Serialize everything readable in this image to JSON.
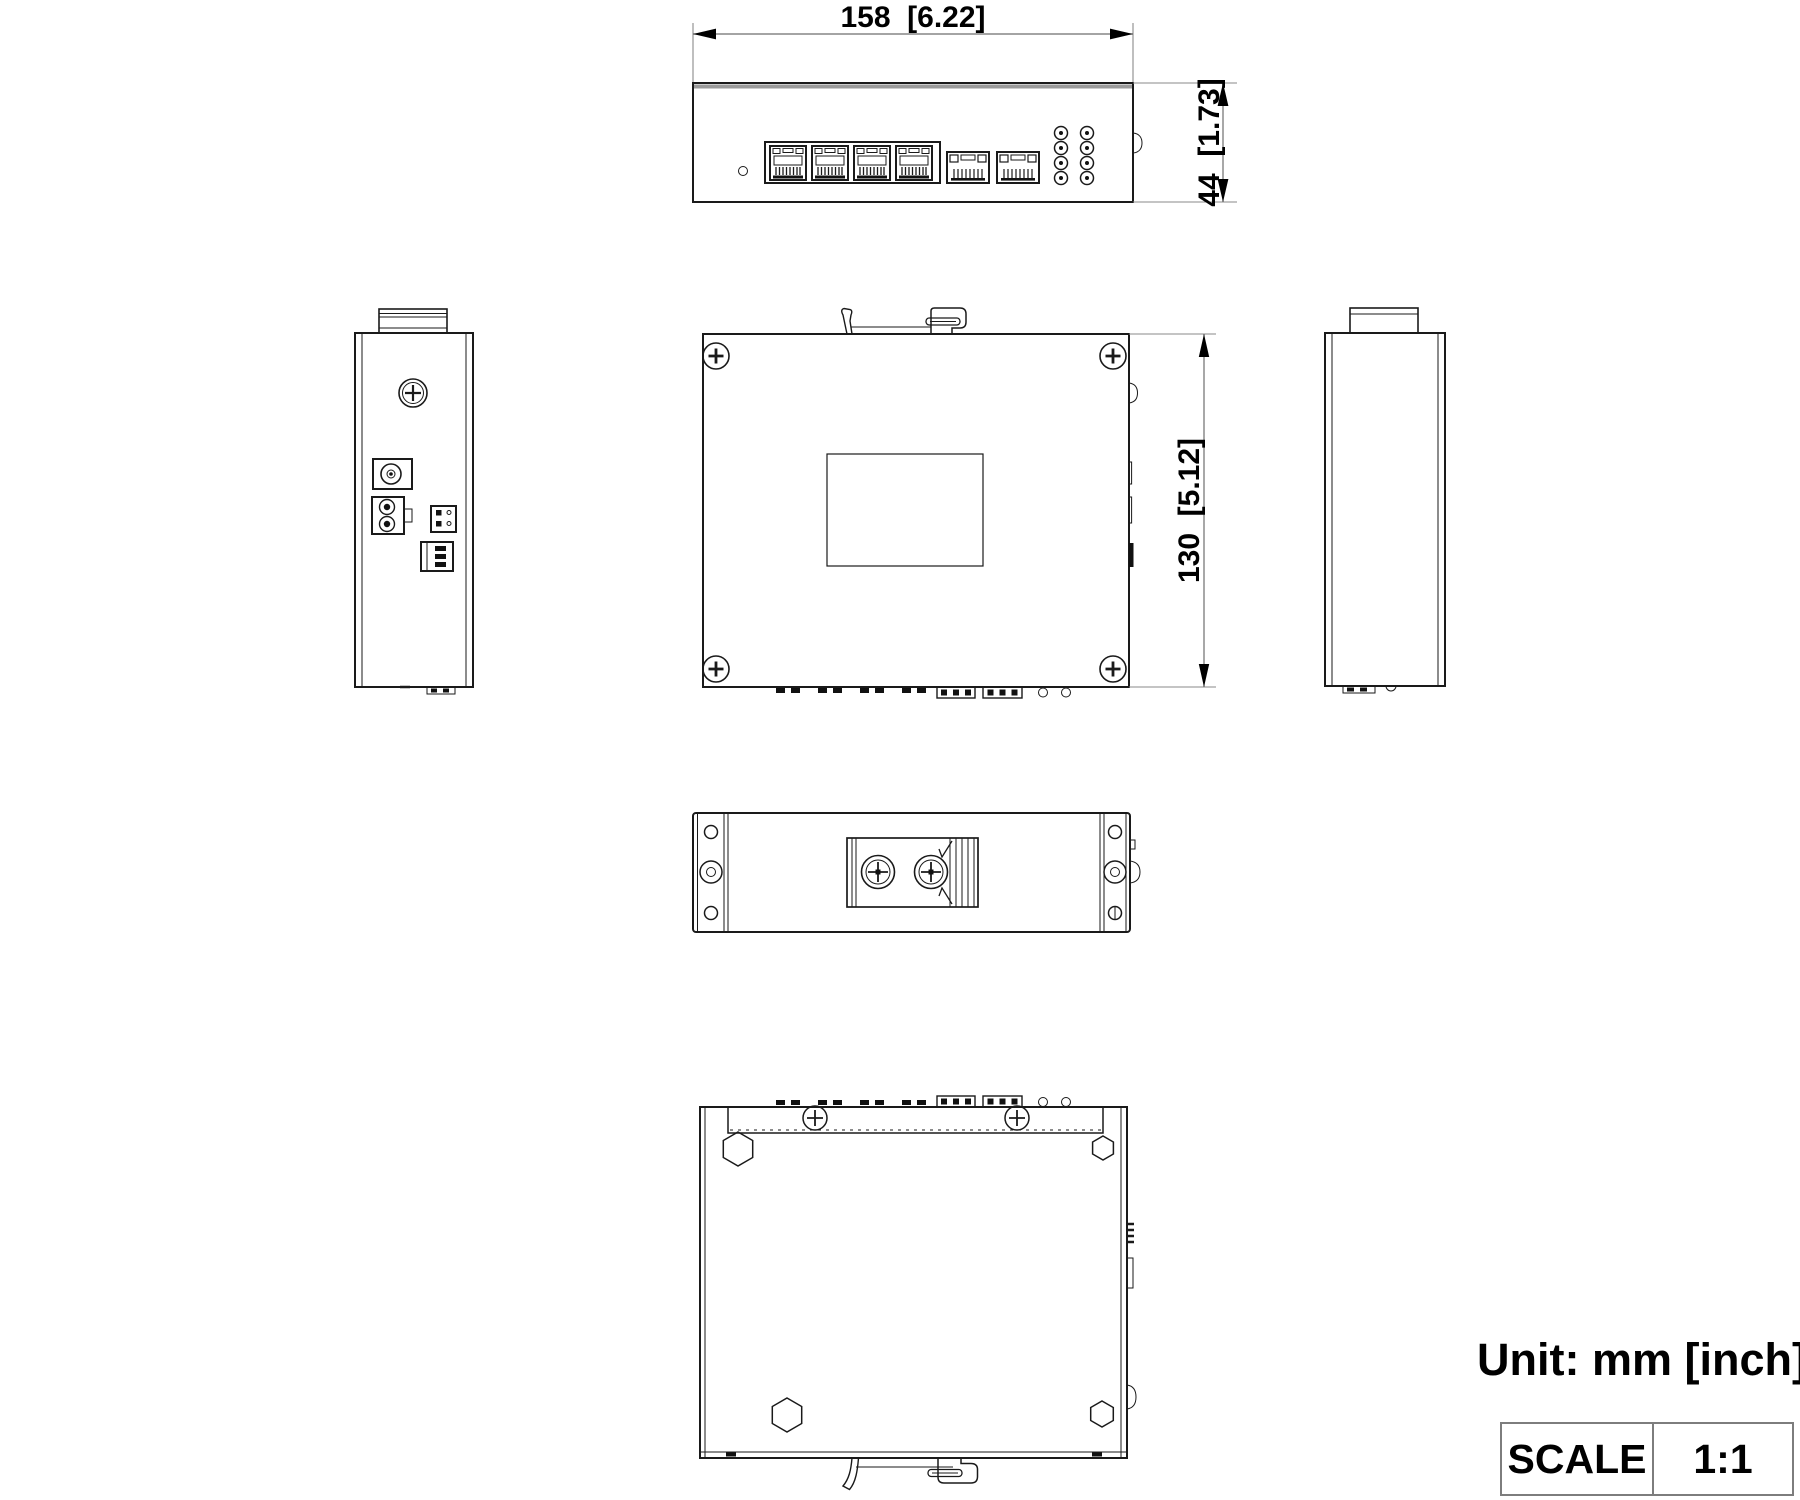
{
  "drawing": {
    "dimensions": {
      "width": "158  [6.22]",
      "height": "44  [1.73]",
      "depth": "130  [5.12]"
    },
    "unit_note": "Unit: mm [inch]",
    "scale": {
      "label": "SCALE",
      "value": "1:1"
    },
    "colors": {
      "line": "#1a1a1a",
      "extension_gray": "#8a8a8a",
      "table_border": "#7d7d7d",
      "background": "#ffffff"
    }
  }
}
